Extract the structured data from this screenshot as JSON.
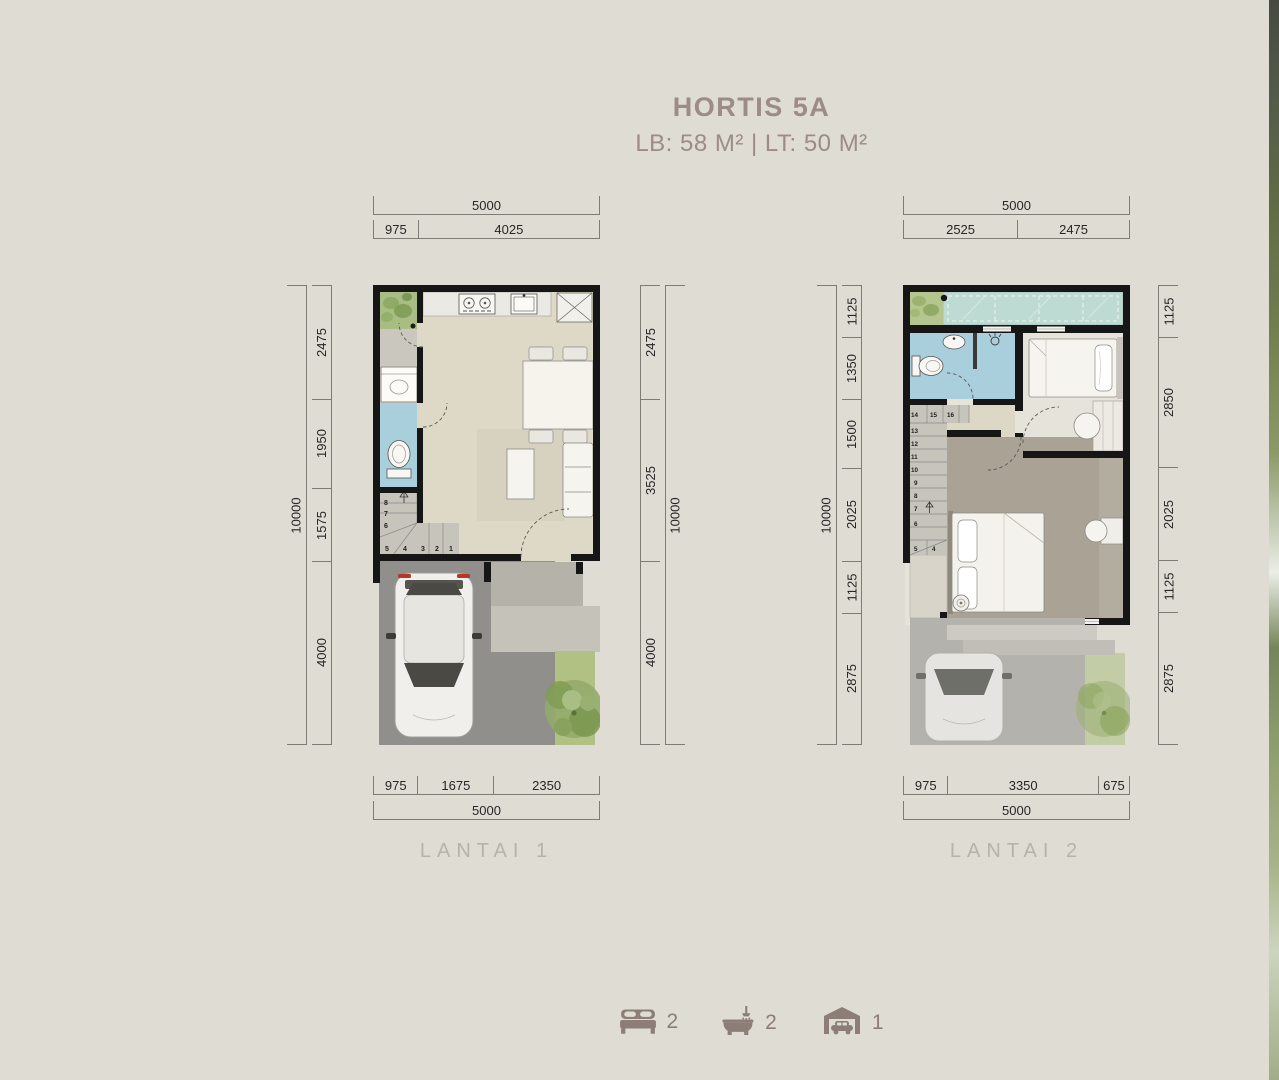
{
  "title": "HORTIS 5A",
  "subtitle": "LB: 58 M²  |  LT: 50 M²",
  "colors": {
    "background": "#dfdcd4",
    "title_text": "#9c8c85",
    "dimension_text": "#262626",
    "dimension_line": "#7d7d76",
    "floor_label": "#b9b2a8",
    "wall": "#161616",
    "floor_beige": "#ded9c7",
    "bathroom_blue": "#a9cedc",
    "glass_teal": "#bedbd3",
    "garden_green": "#b1c184",
    "carport_gray": "#908f8b",
    "master_taupe": "#a9a295",
    "stair_gray": "#c7c4bc",
    "legend_icon": "#8c7e77"
  },
  "floor1": {
    "label": "LANTAI 1",
    "dims": {
      "top_total": "5000",
      "top_segments": [
        "975",
        "4025"
      ],
      "left_total": "10000",
      "left_segments": [
        "2475",
        "1950",
        "1575",
        "4000"
      ],
      "right_segments": [
        "2475",
        "3525",
        "4000"
      ],
      "right_total": "10000",
      "bottom_segments": [
        "975",
        "1675",
        "2350"
      ],
      "bottom_total": "5000"
    },
    "stairs": [
      "1",
      "2",
      "3",
      "4",
      "5",
      "6",
      "7",
      "8"
    ]
  },
  "floor2": {
    "label": "LANTAI 2",
    "dims": {
      "top_total": "5000",
      "top_segments": [
        "2525",
        "2475"
      ],
      "left_total": "10000",
      "left_segments": [
        "1125",
        "1350",
        "1500",
        "2025",
        "1125",
        "2875"
      ],
      "right_segments": [
        "1125",
        "2850",
        "2025",
        "1125",
        "2875"
      ],
      "bottom_segments": [
        "975",
        "3350",
        "675"
      ],
      "bottom_total": "5000"
    },
    "stairs": [
      "4",
      "5",
      "6",
      "7",
      "8",
      "9",
      "10",
      "11",
      "12",
      "13",
      "14",
      "15",
      "16"
    ]
  },
  "legend": {
    "bedrooms": {
      "icon": "bed-icon",
      "count": "2"
    },
    "bathrooms": {
      "icon": "bath-icon",
      "count": "2"
    },
    "garage": {
      "icon": "garage-icon",
      "count": "1"
    }
  }
}
